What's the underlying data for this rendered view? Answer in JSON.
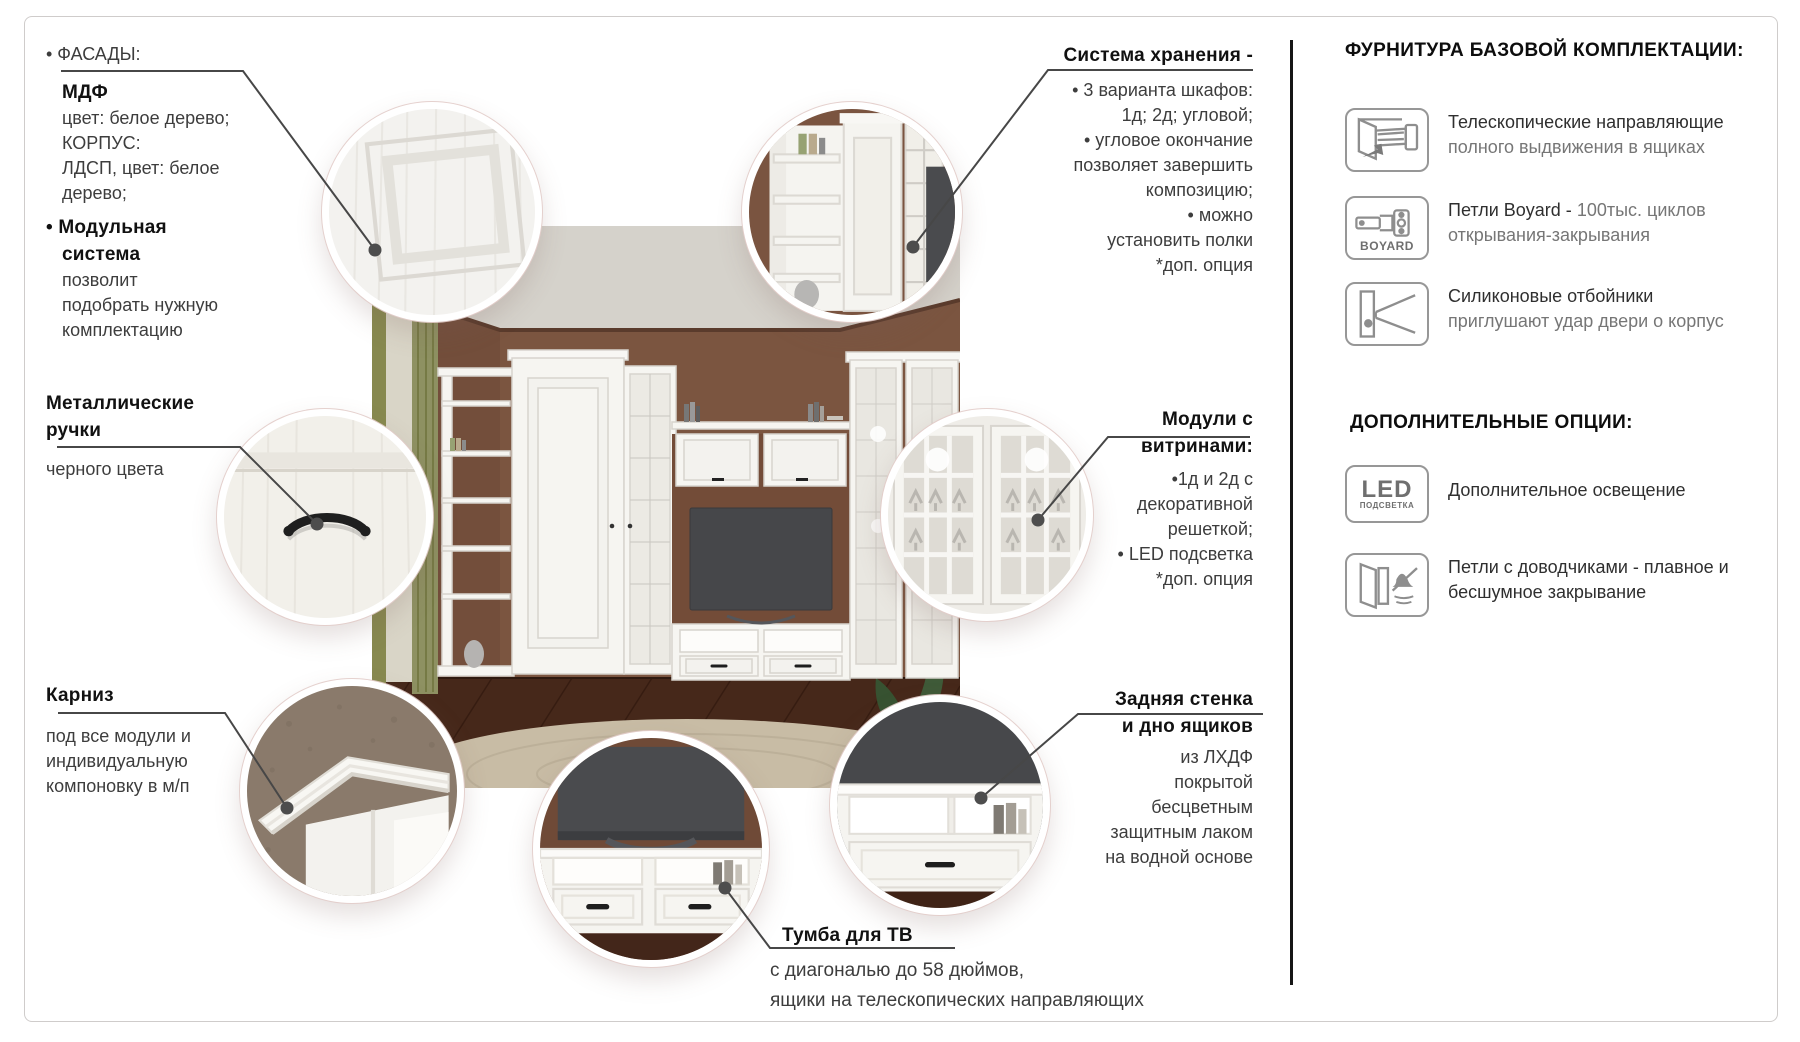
{
  "callouts": {
    "facades": {
      "l1": "• ФАСАДЫ:",
      "l2": "МДФ",
      "l3": "цвет: белое дерево;",
      "l4": "КОРПУС:",
      "l5": "ЛДСП, цвет: белое",
      "l6": "дерево;",
      "l7": "• Модульная",
      "l8": "система",
      "l9": "позволит",
      "l10": "подобрать нужную",
      "l11": "комплектацию"
    },
    "storage": {
      "title": "Система хранения -",
      "l1": "• 3 варианта шкафов:",
      "l2": "1д; 2д; угловой;",
      "l3": "• угловое окончание",
      "l4": "позволяет завершить",
      "l5": "композицию;",
      "l6": "• можно",
      "l7": "установить полки",
      "l8": "*доп. опция"
    },
    "handles": {
      "t1": "Металлические",
      "t2": "ручки",
      "l1": "черного цвета"
    },
    "vitrines": {
      "t1": "Модули с",
      "t2": "витринами:",
      "l1": "•1д и 2д с",
      "l2": "декоративной",
      "l3": "решеткой;",
      "l4": "• LED подсветка",
      "l5": "*доп. опция"
    },
    "cornice": {
      "title": "Карниз",
      "l1": "под все модули и",
      "l2": "индивидуальную",
      "l3": "компоновку в м/п"
    },
    "rear_wall": {
      "t1": "Задняя стенка",
      "t2": "и дно ящиков",
      "l1": "из ЛХДФ",
      "l2": "покрытой",
      "l3": "бесцветным",
      "l4": "защитным лаком",
      "l5": "на водной основе"
    },
    "tv_stand": {
      "title": "Тумба для ТВ",
      "l1": "с диагональю до 58 дюймов,",
      "l2": "ящики на телескопических направляющих"
    }
  },
  "sidebar": {
    "header_base": "ФУРНИТУРА БАЗОВОЙ КОМПЛЕКТАЦИИ:",
    "header_options": "ДОПОЛНИТЕЛЬНЫЕ ОПЦИИ:",
    "base_items": [
      {
        "icon": "telescopic-slides-icon",
        "line1": "Телескопические направляющие",
        "line2": "полного выдвижения в ящиках"
      },
      {
        "icon": "boyard-hinge-icon",
        "icon_label": "BOYARD",
        "line1_dark": "Петли Boyard -",
        "line1_gray": "100тыс. циклов",
        "line2": "открывания-закрывания"
      },
      {
        "icon": "silicone-bumper-icon",
        "line1": "Силиконовые отбойники",
        "line2": "приглушают удар двери о корпус"
      }
    ],
    "option_items": [
      {
        "icon": "led-light-icon",
        "icon_big": "LED",
        "icon_small": "ПОДСВЕТКА",
        "line1": "Дополнительное освещение"
      },
      {
        "icon": "soft-close-hinge-icon",
        "line1": "Петли с доводчиками - плавное и",
        "line2": "бесшумное закрывание"
      }
    ]
  },
  "colors": {
    "wall": "#7B5540",
    "ceiling": "#D5D2CB",
    "floor": "#46281A",
    "rug": "#C8BCA5",
    "curtain": "#8E9162",
    "furniture_white": "#F5F4F0",
    "tv_screen": "#47484B",
    "leader_line": "#474747",
    "divider": "#161616",
    "text_dark": "#111111",
    "text_body": "#3D3D3D",
    "text_muted": "#767676",
    "icon_stroke": "#979797"
  }
}
